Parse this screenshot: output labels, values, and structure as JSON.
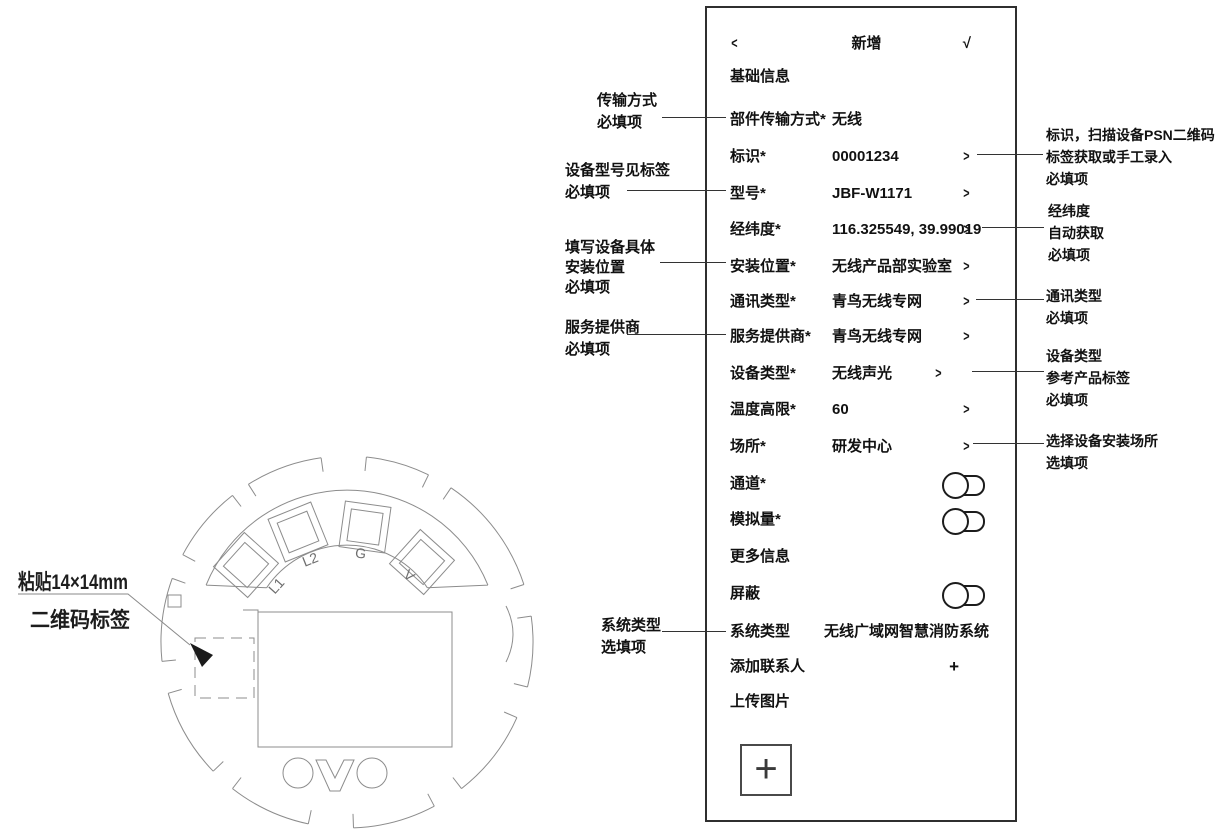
{
  "icons": {
    "back": "<",
    "confirm": "√",
    "chevron": ">",
    "plus": "+",
    "upload_plus": "+"
  },
  "form": {
    "title": "新增",
    "rows": [
      {
        "label": "基础信息",
        "value": "",
        "accessory": "none"
      },
      {
        "label": "部件传输方式*",
        "value": "无线",
        "accessory": "none"
      },
      {
        "label": "标识*",
        "value": "00001234",
        "accessory": "chevron"
      },
      {
        "label": "型号*",
        "value": "JBF-W1171",
        "accessory": "chevron"
      },
      {
        "label": "经纬度*",
        "value": "116.325549, 39.99019",
        "accessory": "chevron"
      },
      {
        "label": "安装位置*",
        "value": "无线产品部实验室",
        "accessory": "chevron"
      },
      {
        "label": "通讯类型*",
        "value": "青鸟无线专网",
        "accessory": "chevron"
      },
      {
        "label": "服务提供商*",
        "value": "青鸟无线专网",
        "accessory": "chevron"
      },
      {
        "label": "设备类型*",
        "value": "无线声光",
        "accessory": "chevron"
      },
      {
        "label": "温度高限*",
        "value": "60",
        "accessory": "chevron"
      },
      {
        "label": "场所*",
        "value": "研发中心",
        "accessory": "chevron"
      },
      {
        "label": "通道*",
        "value": "",
        "accessory": "toggle"
      },
      {
        "label": "模拟量*",
        "value": "",
        "accessory": "toggle"
      },
      {
        "label": "更多信息",
        "value": "",
        "accessory": "none"
      },
      {
        "label": "屏蔽",
        "value": "",
        "accessory": "toggle"
      },
      {
        "label": "系统类型",
        "value": "无线广域网智慧消防系统",
        "accessory": "none"
      },
      {
        "label": "添加联系人",
        "value": "",
        "accessory": "plus"
      },
      {
        "label": "上传图片",
        "value": "",
        "accessory": "none"
      }
    ]
  },
  "callouts_left": [
    {
      "lines": [
        "传输方式",
        "必填项"
      ]
    },
    {
      "lines": [
        "设备型号见标签",
        "必填项"
      ]
    },
    {
      "lines": [
        "填写设备具体",
        "安装位置",
        "必填项"
      ]
    },
    {
      "lines": [
        "服务提供商",
        "必填项"
      ]
    },
    {
      "lines": [
        "系统类型",
        "选填项"
      ]
    }
  ],
  "callouts_right": [
    {
      "lines": [
        "标识，扫描设备PSN二维码",
        "标签获取或手工录入",
        "必填项"
      ]
    },
    {
      "lines": [
        "经纬度",
        "自动获取",
        "必填项"
      ]
    },
    {
      "lines": [
        "通讯类型",
        "必填项"
      ]
    },
    {
      "lines": [
        "设备类型",
        "参考产品标签",
        "必填项"
      ]
    },
    {
      "lines": [
        "选择设备安装场所",
        "选填项"
      ]
    }
  ],
  "drawing": {
    "qr_note": {
      "line1": "粘贴14×14mm",
      "line2": "二维码标签"
    },
    "terminals": [
      "L1",
      "L2",
      "G",
      "V"
    ],
    "dashed_box_color": "#f590dc"
  }
}
